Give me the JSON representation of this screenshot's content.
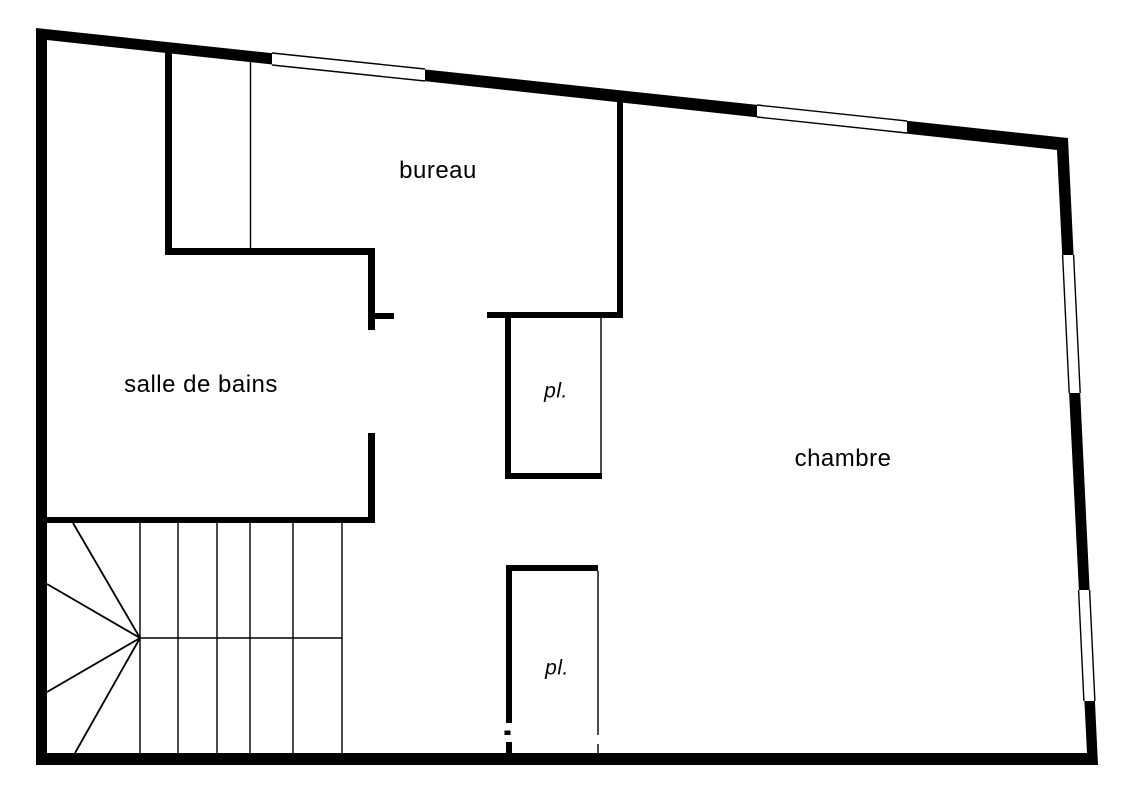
{
  "canvas": {
    "width": 1131,
    "height": 800,
    "background_color": "#ffffff",
    "wall_color": "#000000"
  },
  "rooms": {
    "bureau": {
      "label": "bureau",
      "cx": 438,
      "cy": 171,
      "font_size": 24,
      "italic": false
    },
    "salle_de_bains": {
      "label": "salle de bains",
      "cx": 201,
      "cy": 385,
      "font_size": 24,
      "italic": false
    },
    "chambre": {
      "label": "chambre",
      "cx": 843,
      "cy": 459,
      "font_size": 24,
      "italic": false
    },
    "placard_1": {
      "label": "pl.",
      "cx": 556,
      "cy": 391,
      "font_size": 21,
      "italic": true
    },
    "placard_2": {
      "label": "pl.",
      "cx": 557,
      "cy": 668,
      "font_size": 21,
      "italic": true
    }
  },
  "floorplan": {
    "shell": {
      "outer": [
        [
          36,
          28
        ],
        [
          1068,
          138
        ],
        [
          1098,
          765
        ],
        [
          36,
          765
        ]
      ],
      "inner": [
        [
          47,
          40
        ],
        [
          1057,
          150
        ],
        [
          1087,
          753
        ],
        [
          47,
          753
        ]
      ]
    },
    "windows": [
      {
        "name": "window-top-left",
        "quad": [
          [
            272,
            53
          ],
          [
            425,
            69
          ],
          [
            425,
            81
          ],
          [
            272,
            65
          ]
        ],
        "frame_edges": [
          [
            0,
            1
          ],
          [
            3,
            2
          ]
        ]
      },
      {
        "name": "window-top-right",
        "quad": [
          [
            757,
            105
          ],
          [
            907,
            121
          ],
          [
            907,
            133
          ],
          [
            757,
            117
          ]
        ],
        "frame_edges": [
          [
            0,
            1
          ],
          [
            3,
            2
          ]
        ]
      },
      {
        "name": "window-right-upper",
        "quad": [
          [
            1062.6,
            255
          ],
          [
            1073.6,
            255
          ],
          [
            1080.2,
            393
          ],
          [
            1069.2,
            393
          ]
        ],
        "frame_edges": [
          [
            0,
            3
          ],
          [
            1,
            2
          ]
        ]
      },
      {
        "name": "window-right-lower",
        "quad": [
          [
            1078.6,
            590
          ],
          [
            1089.6,
            590
          ],
          [
            1094.9,
            701
          ],
          [
            1083.9,
            701
          ]
        ],
        "frame_edges": [
          [
            0,
            3
          ],
          [
            1,
            2
          ]
        ]
      }
    ],
    "interior_walls": [
      {
        "name": "niche-left-wall",
        "rect": [
          165,
          46,
          7,
          209
        ]
      },
      {
        "name": "bathroom-top-wall",
        "rect": [
          165,
          248,
          210,
          7
        ]
      },
      {
        "name": "bathroom-right-wall-upper",
        "rect": [
          368,
          248,
          7,
          82
        ]
      },
      {
        "name": "bathroom-door-jamb",
        "rect": [
          375,
          313,
          19,
          6
        ]
      },
      {
        "name": "bathroom-right-wall-lower",
        "rect": [
          368,
          433,
          7,
          90
        ]
      },
      {
        "name": "stair-top-wall",
        "rect": [
          47,
          517,
          328,
          6
        ]
      },
      {
        "name": "bureau-right-wall",
        "rect": [
          617,
          96,
          6,
          222
        ]
      },
      {
        "name": "closet-1-top-wall",
        "rect": [
          487,
          312,
          136,
          6
        ]
      },
      {
        "name": "closet-1-left-wall",
        "rect": [
          505,
          318,
          6,
          161
        ]
      },
      {
        "name": "closet-1-bottom-wall",
        "rect": [
          505,
          473,
          97,
          6
        ]
      },
      {
        "name": "closet-2-top-wall",
        "rect": [
          506,
          565,
          92,
          6
        ]
      },
      {
        "name": "closet-2-left-wall",
        "rect": [
          506,
          571,
          6,
          182
        ]
      }
    ],
    "thin_walls": [
      {
        "name": "niche-partition-line",
        "line": [
          250.5,
          62,
          250.5,
          250
        ]
      },
      {
        "name": "closet-1-right-wall",
        "line": [
          601,
          318,
          601,
          473
        ]
      },
      {
        "name": "closet-2-right-wall-upper",
        "line": [
          598,
          571,
          598,
          735
        ]
      },
      {
        "name": "closet-2-right-wall-lower",
        "line": [
          598,
          744,
          598,
          753
        ]
      }
    ],
    "stairs": {
      "convergence_point": [
        140,
        638
      ],
      "treads": [
        [
          140,
          523,
          140,
          753
        ],
        [
          178,
          523,
          178,
          753
        ],
        [
          217,
          523,
          217,
          753
        ],
        [
          250,
          523,
          250,
          753
        ],
        [
          293,
          523,
          293,
          753
        ],
        [
          342,
          523,
          342,
          753
        ]
      ],
      "mid_line": [
        140,
        638,
        342,
        638
      ],
      "radials": [
        [
          140,
          638,
          73,
          523
        ],
        [
          140,
          638,
          47,
          584
        ],
        [
          140,
          638,
          47,
          692
        ],
        [
          140,
          638,
          75,
          753
        ]
      ]
    },
    "artifacts": {
      "white_notch_rect": [
        504.5,
        723,
        8.5,
        19
      ],
      "white_notch_bar": [
        504.5,
        730.5,
        6,
        4.5
      ]
    }
  }
}
